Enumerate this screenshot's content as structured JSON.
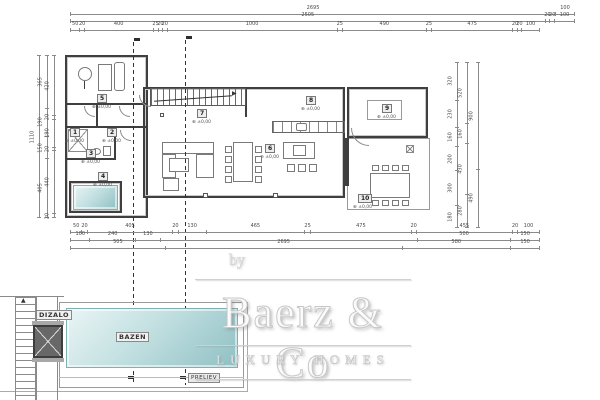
{
  "plan": {
    "rooms": [
      {
        "num": "1",
        "x": 70,
        "y": 128,
        "elev": "±0,00"
      },
      {
        "num": "2",
        "x": 107,
        "y": 128,
        "elev": "±0,00"
      },
      {
        "num": "3",
        "x": 86,
        "y": 149,
        "elev": "±0,00"
      },
      {
        "num": "4",
        "x": 98,
        "y": 172,
        "elev": "±0,00"
      },
      {
        "num": "5",
        "x": 97,
        "y": 94,
        "elev": "±0,00"
      },
      {
        "num": "6",
        "x": 265,
        "y": 144,
        "elev": "±0,00"
      },
      {
        "num": "7",
        "x": 197,
        "y": 109,
        "elev": "±0,00"
      },
      {
        "num": "8",
        "x": 306,
        "y": 96,
        "elev": "±0,00"
      },
      {
        "num": "9",
        "x": 382,
        "y": 104,
        "elev": "±0,00"
      },
      {
        "num": "10",
        "x": 358,
        "y": 194,
        "elev": "±0,00"
      }
    ],
    "labels": {
      "pool": "BAZEN",
      "lift": "DIZALO",
      "overflow": "PRELJEV"
    }
  },
  "watermark": {
    "by": "by",
    "brand": "Baerz & Co",
    "tagline": "LUXURY HOMES"
  },
  "dims": {
    "chains": [
      {
        "x": 70,
        "y": 12,
        "len": 505,
        "dir": "h",
        "values": [
          [
            "2695",
            2695
          ],
          [
            "100",
            100
          ]
        ]
      },
      {
        "x": 70,
        "y": 19,
        "len": 505,
        "dir": "h",
        "values": [
          [
            "2505",
            2505
          ],
          [
            "20",
            20
          ],
          [
            "20",
            20
          ],
          [
            "100",
            100
          ]
        ]
      },
      {
        "x": 70,
        "y": 28,
        "len": 470,
        "dir": "h",
        "values": [
          [
            "50",
            50
          ],
          [
            "20",
            20
          ],
          [
            "400",
            400
          ],
          [
            "25",
            25
          ],
          [
            "20",
            20
          ],
          [
            "20",
            20
          ],
          [
            "1000",
            1000
          ],
          [
            "25",
            25
          ],
          [
            "490",
            490
          ],
          [
            "25",
            25
          ],
          [
            "475",
            475
          ],
          [
            "20",
            20
          ],
          [
            "20",
            20
          ],
          [
            "100",
            100
          ]
        ]
      },
      {
        "x": 37,
        "y": 55,
        "len": 163,
        "dir": "v",
        "values": [
          [
            "1110",
            1110
          ]
        ]
      },
      {
        "x": 45,
        "y": 55,
        "len": 163,
        "dir": "v",
        "values": [
          [
            "365",
            365
          ],
          [
            "190",
            190
          ],
          [
            "150",
            150
          ],
          [
            "405",
            405
          ]
        ]
      },
      {
        "x": 52,
        "y": 55,
        "len": 163,
        "dir": "v",
        "values": [
          [
            "420",
            420
          ],
          [
            "20",
            20
          ],
          [
            "190",
            190
          ],
          [
            "20",
            20
          ],
          [
            "440",
            440
          ],
          [
            "20",
            20
          ]
        ]
      },
      {
        "x": 455,
        "y": 62,
        "len": 166,
        "dir": "v",
        "values": [
          [
            "320",
            320
          ],
          [
            "230",
            230
          ],
          [
            "160",
            160
          ],
          [
            "200",
            200
          ],
          [
            "300",
            300
          ],
          [
            "180",
            180
          ]
        ]
      },
      {
        "x": 465,
        "y": 62,
        "len": 166,
        "dir": "v",
        "values": [
          [
            "520",
            520
          ],
          [
            "160",
            160
          ],
          [
            "430",
            430
          ],
          [
            "280",
            280
          ]
        ]
      },
      {
        "x": 476,
        "y": 62,
        "len": 166,
        "dir": "v",
        "values": [
          [
            "900",
            900
          ],
          [
            "490",
            490
          ]
        ]
      },
      {
        "x": 70,
        "y": 230,
        "len": 470,
        "dir": "h",
        "values": [
          [
            "50",
            50
          ],
          [
            "20",
            20
          ],
          [
            "405",
            405
          ],
          [
            "20",
            20
          ],
          [
            "130",
            130
          ],
          [
            "465",
            465
          ],
          [
            "25",
            25
          ],
          [
            "475",
            475
          ],
          [
            "20",
            20
          ],
          [
            "455",
            455
          ],
          [
            "20",
            20
          ],
          [
            "100",
            100
          ]
        ]
      },
      {
        "x": 70,
        "y": 238,
        "len": 470,
        "dir": "h",
        "values": [
          [
            "100",
            100
          ],
          [
            "240",
            240
          ],
          [
            "130",
            130
          ],
          [
            "",
            1385
          ],
          [
            "500",
            500
          ],
          [
            "150",
            150
          ]
        ]
      },
      {
        "x": 70,
        "y": 246,
        "len": 470,
        "dir": "h",
        "values": [
          [
            "505",
            505
          ],
          [
            "2695",
            1270
          ],
          [
            "580",
            580
          ],
          [
            "150",
            150
          ]
        ]
      }
    ]
  },
  "colors": {
    "pool_light": "#e9f5f5",
    "pool_deep": "#8fc0c4",
    "wall": "#3f3f3f",
    "dim_line": "#8a8a8a",
    "lift_fill": "#686868"
  }
}
